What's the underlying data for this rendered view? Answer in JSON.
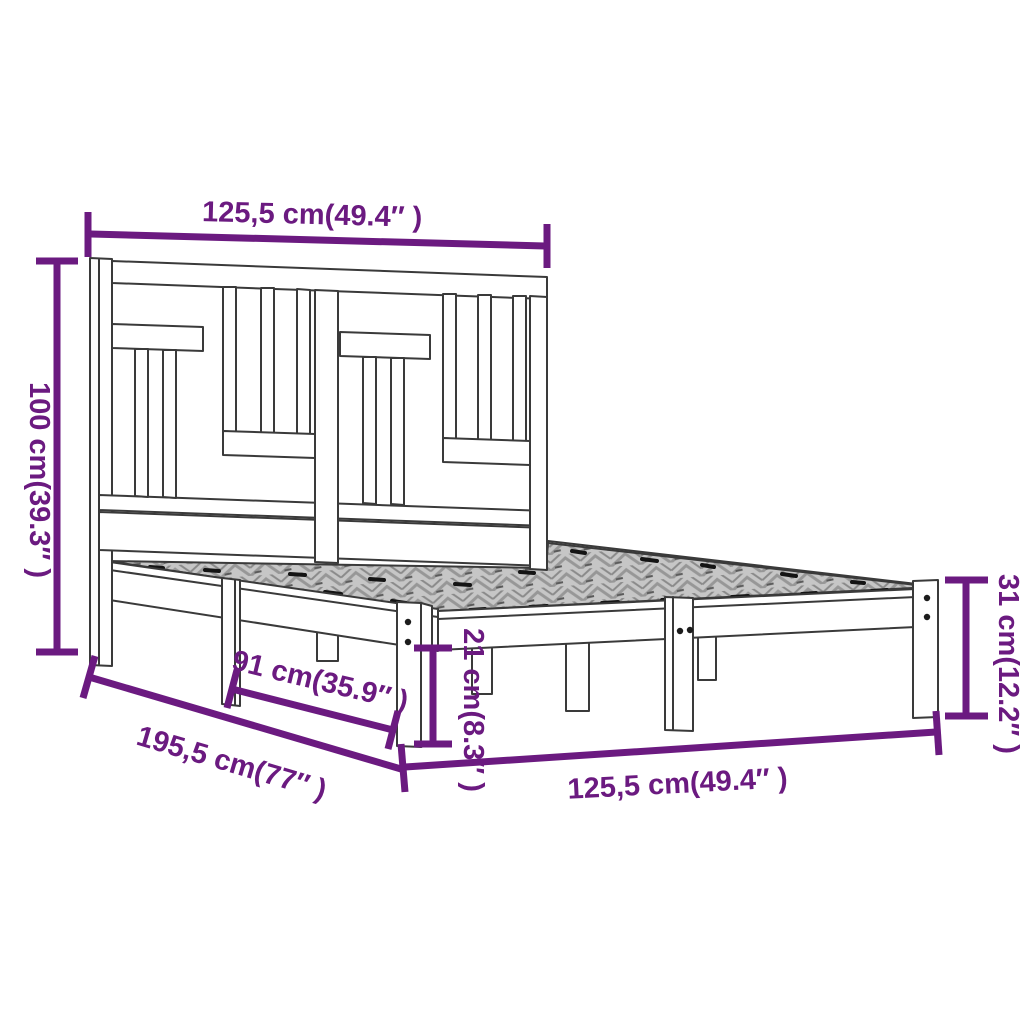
{
  "meta": {
    "type": "product-dimension-diagram",
    "subject": "wooden bed frame with slatted headboard, isometric line drawing"
  },
  "colors": {
    "dimension_accent": "#6b1a80",
    "drawing_line": "#3a3a3a",
    "slat_texture_base": "#c6c6c6",
    "background": "#ffffff"
  },
  "labels": {
    "headboard_width": "125,5 cm(49.4″ )",
    "headboard_height": "100 cm(39.3″ )",
    "bed_length": "195,5 cm(77″ )",
    "leg_span": "91 cm(35.9″ )",
    "under_bed_clearance": "21 cm(8.3″ )",
    "frame_height": "31 cm(12.2″ )",
    "bed_width": "125,5 cm(49.4″ )"
  }
}
